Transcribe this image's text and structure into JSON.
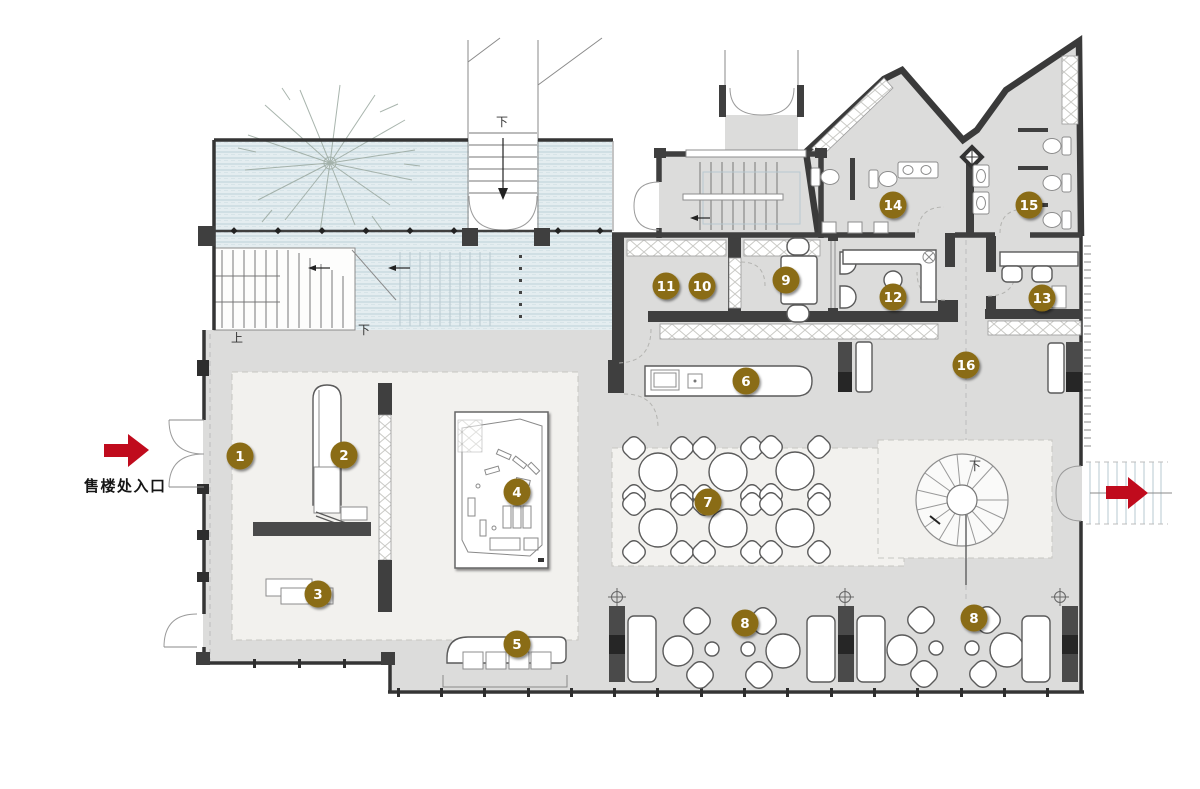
{
  "labels": {
    "entrance": "售楼处入口",
    "up": "上",
    "down": "下"
  },
  "markers": [
    {
      "label": "1"
    },
    {
      "label": "2"
    },
    {
      "label": "3"
    },
    {
      "label": "4"
    },
    {
      "label": "5"
    },
    {
      "label": "6"
    },
    {
      "label": "7"
    },
    {
      "label": "8"
    },
    {
      "label": "8"
    },
    {
      "label": "9"
    },
    {
      "label": "10"
    },
    {
      "label": "11"
    },
    {
      "label": "12"
    },
    {
      "label": "13"
    },
    {
      "label": "14"
    },
    {
      "label": "15"
    },
    {
      "label": "16"
    }
  ],
  "colors": {
    "marker": "#8a6c15",
    "marker_text": "#ffffff",
    "water": "#e4edf0",
    "water_line": "#bdd1d9",
    "floor": "#dcdcdb",
    "zone": "#f2f1ee",
    "wall": "#3f3f3f",
    "arrow_red": "#c00b1d",
    "furniture_stroke": "#5a5a5a"
  }
}
